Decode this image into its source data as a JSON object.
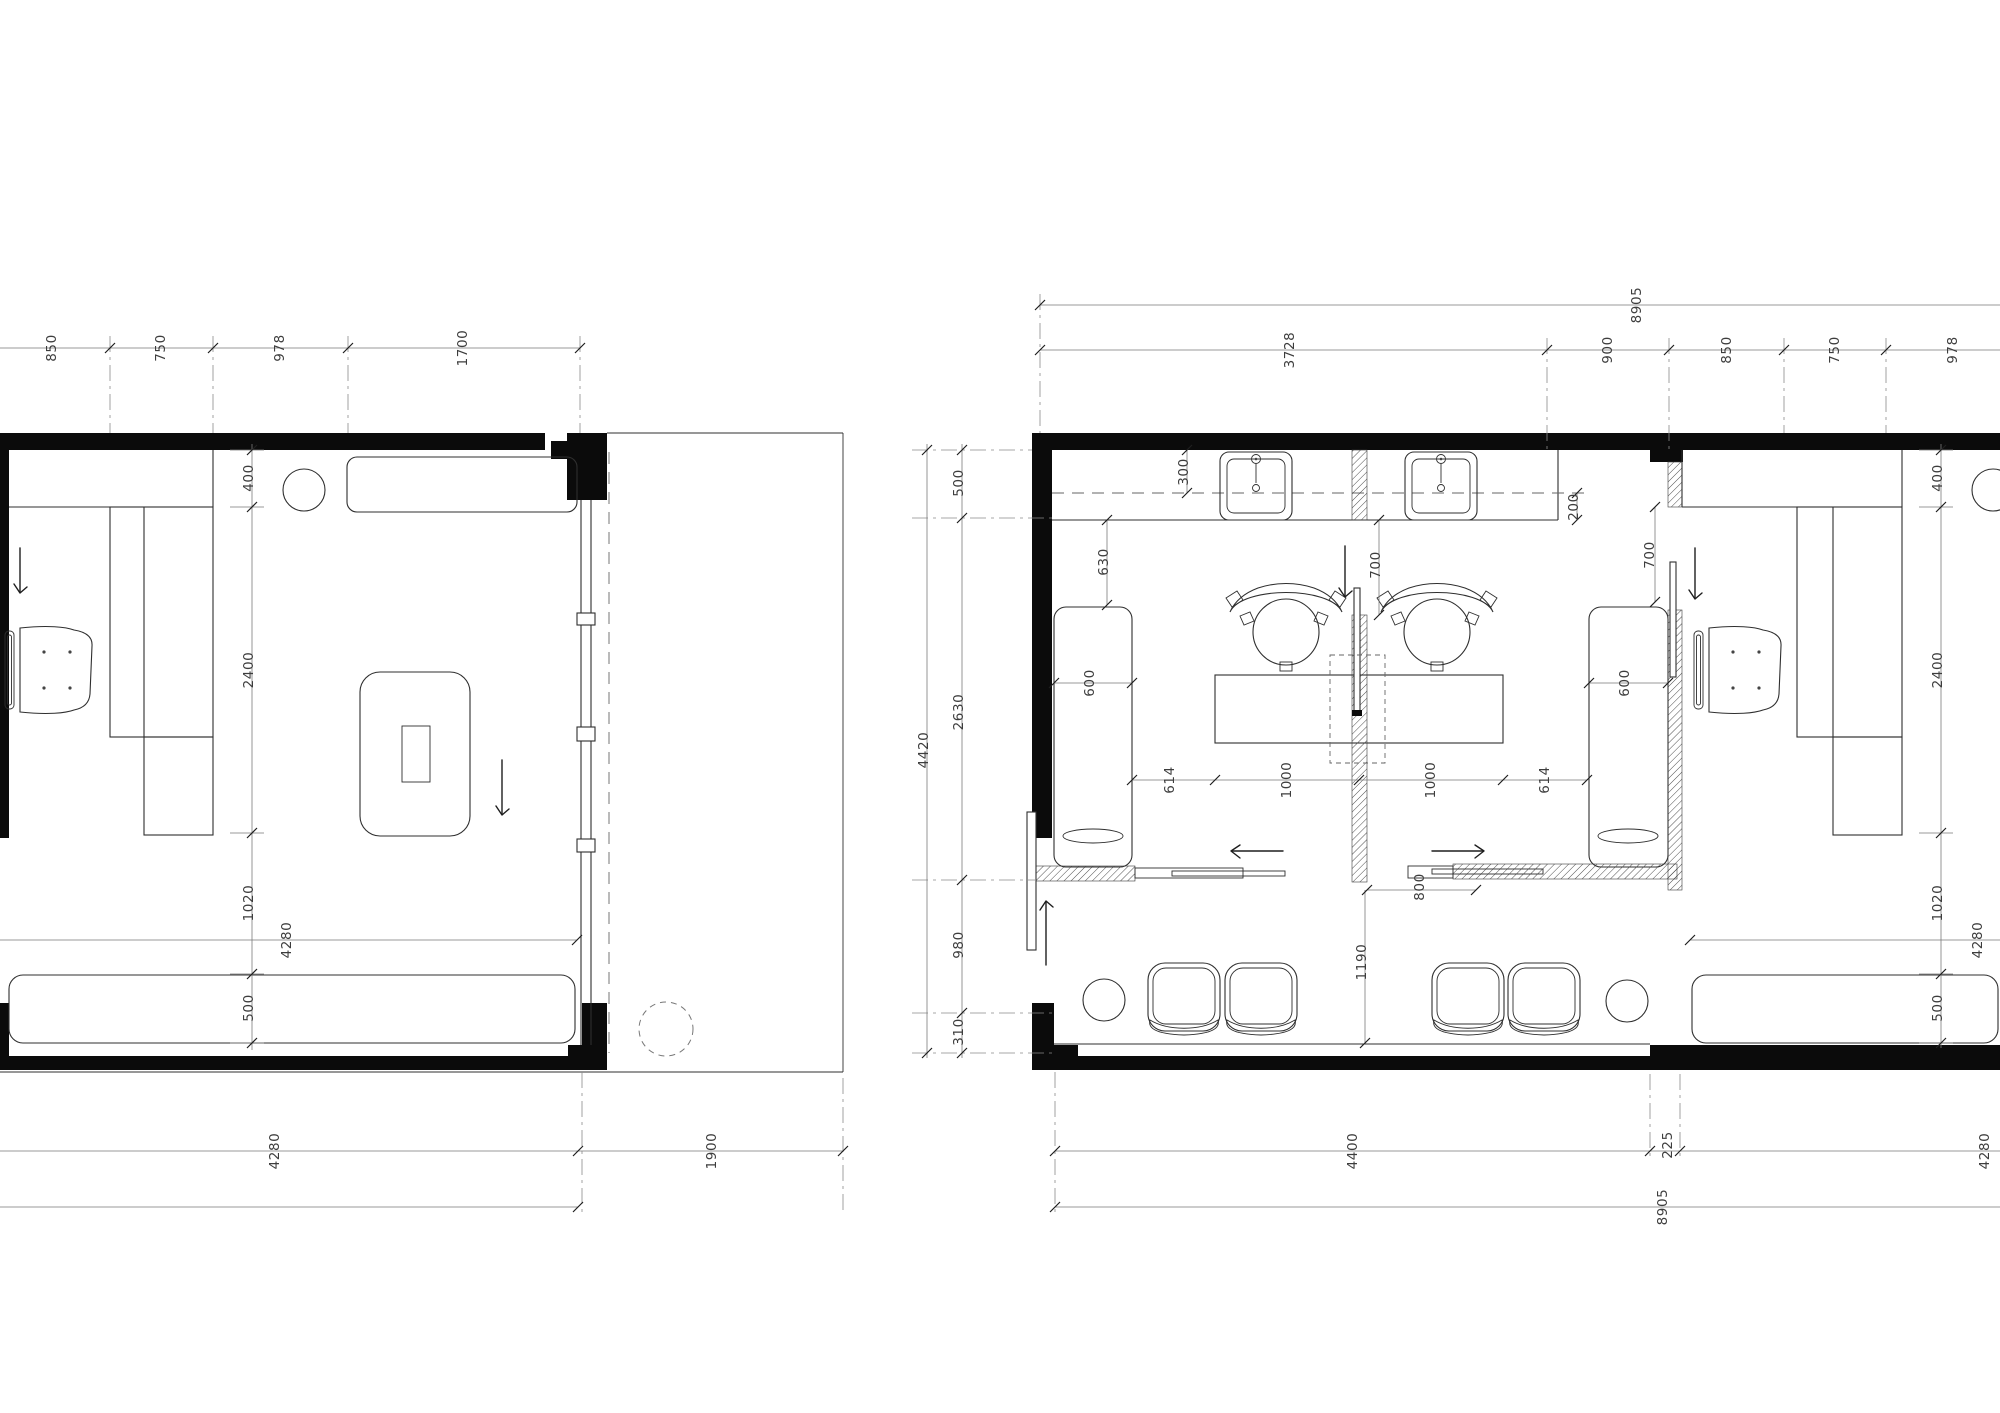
{
  "left_plan": {
    "top_dims": [
      "850",
      "750",
      "978",
      "1700"
    ],
    "side_dims": [
      "400",
      "2400",
      "1020",
      "500"
    ],
    "inner_width": "4280",
    "bottom_width": "4280",
    "terrace_width": "1900"
  },
  "right_plan": {
    "top_overall": "8905",
    "top_dims": [
      "3728",
      "900",
      "850",
      "750",
      "978"
    ],
    "left_overall": "4420",
    "left_dims": [
      "500",
      "2630",
      "980",
      "310"
    ],
    "salon_dims": {
      "wall_to_line": "300",
      "counter_end": "200",
      "bench_offset": "630",
      "bench_width_left": "600",
      "bench_width_right": "600",
      "glass_door_left": "700",
      "glass_door_right": "700",
      "floor_chain": [
        "614",
        "1000",
        "1000",
        "614"
      ],
      "slide_opening": "800",
      "lounge_depth": "1190"
    },
    "room_dims": {
      "side_dims": [
        "400",
        "2400",
        "1020",
        "500"
      ],
      "inner_width": "4280"
    },
    "bottom_dims": [
      "4400",
      "225",
      "4280"
    ],
    "bottom_overall": "8905"
  }
}
